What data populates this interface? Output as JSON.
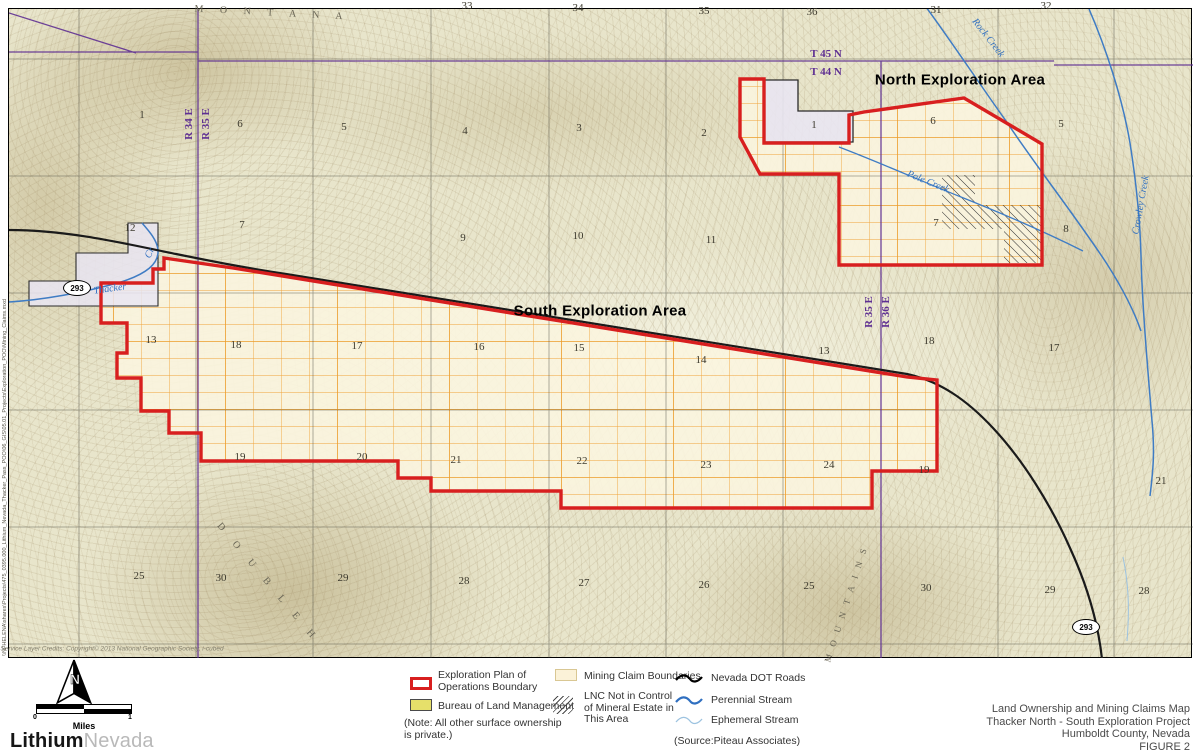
{
  "colors": {
    "boundary_red": "#d81f1f",
    "claim_orange": "#f0a238",
    "claim_fill": "#fbf6df",
    "township_purple": "#5e2f92",
    "stream_blue": "#3f7cc4",
    "ephemeral_blue": "#9dc3e0",
    "road_black": "#1a1a1a",
    "blm_yellow": "#e6e06a",
    "private_lavender": "#e9e5f2",
    "map_base": "#e8e5cb"
  },
  "map": {
    "labels": [
      {
        "t": "33",
        "x": 467,
        "y": 6,
        "cls": "sec",
        "name": "section-number"
      },
      {
        "t": "34",
        "x": 578,
        "y": 8,
        "cls": "sec",
        "name": "section-number"
      },
      {
        "t": "35",
        "x": 704,
        "y": 11,
        "cls": "sec",
        "name": "section-number"
      },
      {
        "t": "36",
        "x": 812,
        "y": 12,
        "cls": "sec",
        "name": "section-number"
      },
      {
        "t": "31",
        "x": 936,
        "y": 10,
        "cls": "sec",
        "name": "section-number"
      },
      {
        "t": "32",
        "x": 1046,
        "y": 6,
        "cls": "sec",
        "name": "section-number"
      },
      {
        "t": "1",
        "x": 142,
        "y": 115,
        "cls": "sec",
        "name": "section-number"
      },
      {
        "t": "6",
        "x": 240,
        "y": 124,
        "cls": "sec",
        "name": "section-number"
      },
      {
        "t": "5",
        "x": 344,
        "y": 127,
        "cls": "sec",
        "name": "section-number"
      },
      {
        "t": "4",
        "x": 465,
        "y": 131,
        "cls": "sec",
        "name": "section-number"
      },
      {
        "t": "3",
        "x": 579,
        "y": 128,
        "cls": "sec",
        "name": "section-number"
      },
      {
        "t": "2",
        "x": 704,
        "y": 133,
        "cls": "sec",
        "name": "section-number"
      },
      {
        "t": "1",
        "x": 814,
        "y": 125,
        "cls": "sec",
        "name": "section-number"
      },
      {
        "t": "6",
        "x": 933,
        "y": 121,
        "cls": "sec",
        "name": "section-number"
      },
      {
        "t": "5",
        "x": 1061,
        "y": 124,
        "cls": "sec",
        "name": "section-number"
      },
      {
        "t": "12",
        "x": 130,
        "y": 228,
        "cls": "sec",
        "name": "section-number"
      },
      {
        "t": "7",
        "x": 242,
        "y": 225,
        "cls": "sec",
        "name": "section-number"
      },
      {
        "t": "9",
        "x": 463,
        "y": 238,
        "cls": "sec",
        "name": "section-number"
      },
      {
        "t": "10",
        "x": 578,
        "y": 236,
        "cls": "sec",
        "name": "section-number"
      },
      {
        "t": "11",
        "x": 711,
        "y": 240,
        "cls": "sec",
        "name": "section-number"
      },
      {
        "t": "7",
        "x": 936,
        "y": 223,
        "cls": "sec",
        "name": "section-number"
      },
      {
        "t": "8",
        "x": 1066,
        "y": 229,
        "cls": "sec",
        "name": "section-number"
      },
      {
        "t": "13",
        "x": 151,
        "y": 340,
        "cls": "sec",
        "name": "section-number"
      },
      {
        "t": "18",
        "x": 236,
        "y": 345,
        "cls": "sec",
        "name": "section-number"
      },
      {
        "t": "17",
        "x": 357,
        "y": 346,
        "cls": "sec",
        "name": "section-number"
      },
      {
        "t": "16",
        "x": 479,
        "y": 347,
        "cls": "sec",
        "name": "section-number"
      },
      {
        "t": "15",
        "x": 579,
        "y": 348,
        "cls": "sec",
        "name": "section-number"
      },
      {
        "t": "14",
        "x": 701,
        "y": 360,
        "cls": "sec",
        "name": "section-number"
      },
      {
        "t": "13",
        "x": 824,
        "y": 351,
        "cls": "sec",
        "name": "section-number"
      },
      {
        "t": "18",
        "x": 929,
        "y": 341,
        "cls": "sec",
        "name": "section-number"
      },
      {
        "t": "17",
        "x": 1054,
        "y": 348,
        "cls": "sec",
        "name": "section-number"
      },
      {
        "t": "19",
        "x": 240,
        "y": 457,
        "cls": "sec",
        "name": "section-number"
      },
      {
        "t": "20",
        "x": 362,
        "y": 457,
        "cls": "sec",
        "name": "section-number"
      },
      {
        "t": "21",
        "x": 456,
        "y": 460,
        "cls": "sec",
        "name": "section-number"
      },
      {
        "t": "22",
        "x": 582,
        "y": 461,
        "cls": "sec",
        "name": "section-number"
      },
      {
        "t": "23",
        "x": 706,
        "y": 465,
        "cls": "sec",
        "name": "section-number"
      },
      {
        "t": "24",
        "x": 829,
        "y": 465,
        "cls": "sec",
        "name": "section-number"
      },
      {
        "t": "19",
        "x": 924,
        "y": 470,
        "cls": "sec",
        "name": "section-number"
      },
      {
        "t": "21",
        "x": 1161,
        "y": 481,
        "cls": "sec",
        "name": "section-number"
      },
      {
        "t": "25",
        "x": 139,
        "y": 576,
        "cls": "sec",
        "name": "section-number"
      },
      {
        "t": "30",
        "x": 221,
        "y": 578,
        "cls": "sec",
        "name": "section-number"
      },
      {
        "t": "29",
        "x": 343,
        "y": 578,
        "cls": "sec",
        "name": "section-number"
      },
      {
        "t": "28",
        "x": 464,
        "y": 581,
        "cls": "sec",
        "name": "section-number"
      },
      {
        "t": "27",
        "x": 584,
        "y": 583,
        "cls": "sec",
        "name": "section-number"
      },
      {
        "t": "26",
        "x": 704,
        "y": 585,
        "cls": "sec",
        "name": "section-number"
      },
      {
        "t": "25",
        "x": 809,
        "y": 586,
        "cls": "sec",
        "name": "section-number"
      },
      {
        "t": "30",
        "x": 926,
        "y": 588,
        "cls": "sec",
        "name": "section-number"
      },
      {
        "t": "29",
        "x": 1050,
        "y": 590,
        "cls": "sec",
        "name": "section-number"
      },
      {
        "t": "28",
        "x": 1144,
        "y": 591,
        "cls": "sec",
        "name": "section-number"
      },
      {
        "t": "T 45 N",
        "x": 826,
        "y": 54,
        "cls": "town",
        "name": "township-label"
      },
      {
        "t": "T 44 N",
        "x": 826,
        "y": 72,
        "cls": "town",
        "name": "township-label"
      },
      {
        "t": "R 34 E",
        "x": 189,
        "y": 124,
        "cls": "range",
        "rot": -90,
        "name": "range-label"
      },
      {
        "t": "R 35 E",
        "x": 206,
        "y": 124,
        "cls": "range",
        "rot": -90,
        "name": "range-label"
      },
      {
        "t": "R 35 E",
        "x": 869,
        "y": 312,
        "cls": "range",
        "rot": -90,
        "name": "range-label"
      },
      {
        "t": "R 36 E",
        "x": 886,
        "y": 312,
        "cls": "range",
        "rot": -90,
        "name": "range-label"
      },
      {
        "t": "North Exploration Area",
        "x": 960,
        "y": 80,
        "cls": "area",
        "name": "north-area-label"
      },
      {
        "t": "South Exploration Area",
        "x": 600,
        "y": 311,
        "cls": "area",
        "name": "south-area-label"
      },
      {
        "t": "Rock Creek",
        "x": 988,
        "y": 38,
        "cls": "creek",
        "rot": 52,
        "name": "creek-label"
      },
      {
        "t": "Crowley Creek",
        "x": 1141,
        "y": 205,
        "cls": "creek",
        "rot": -80,
        "name": "creek-label"
      },
      {
        "t": "Pole Creek",
        "x": 928,
        "y": 182,
        "cls": "creek",
        "rot": 22,
        "name": "creek-label"
      },
      {
        "t": "Thacker",
        "x": 110,
        "y": 289,
        "cls": "creek",
        "rot": -8,
        "name": "creek-label"
      },
      {
        "t": "Cr",
        "x": 150,
        "y": 253,
        "cls": "creek",
        "rot": -65,
        "name": "creek-label"
      },
      {
        "t": "M O N T A N A",
        "x": 272,
        "y": 13,
        "cls": "mtn",
        "rot": 3,
        "name": "mountain-label"
      },
      {
        "t": "D O U B L E   H",
        "x": 268,
        "y": 583,
        "cls": "mtn",
        "rot": 50,
        "name": "mountain-label"
      },
      {
        "t": "M O U N T A I N S",
        "x": 846,
        "y": 604,
        "cls": "mtn mtn2",
        "rot": -72,
        "name": "mountain-label"
      },
      {
        "t": "Service Layer Credits: Copyright© 2013 National Geographic Society, i-cubed",
        "x": 112,
        "y": 649,
        "cls": "credits",
        "name": "credits-text"
      }
    ],
    "shields": [
      {
        "label": "293",
        "x": 77,
        "y": 288
      },
      {
        "label": "293",
        "x": 1086,
        "y": 627
      }
    ],
    "file_path": "\\\\NFHELENA\\shares\\Projects\\475_0395.000_Lithium_Nevada_Thacker_Pass_POO\\06_GIS\\05.01_Projects\\Exploration_POO\\Mining_Claims.mxd"
  },
  "legend": {
    "exploration_line1": "Exploration Plan of",
    "exploration_line2": "Operations Boundary",
    "blm": "Bureau of Land Management",
    "note_line1": "(Note: All other surface ownership",
    "note_line2": "is private.)",
    "claims": "Mining Claim Boundaries",
    "lnc_line1": "LNC Not in Control",
    "lnc_line2": "of Mineral Estate in",
    "lnc_line3": "This Area",
    "roads": "Nevada DOT Roads",
    "perennial": "Perennial Stream",
    "ephemeral": "Ephemeral Stream",
    "source": "(Source:Piteau Associates)"
  },
  "footer": {
    "north_arrow_letter": "N",
    "scale_left": "0",
    "scale_right": "1",
    "scale_units": "Miles",
    "logo_bold": "Lithium",
    "logo_light": "Nevada",
    "title_line1": "Land Ownership and Mining Claims Map",
    "title_line2": "Thacker North - South Exploration Project",
    "title_line3": "Humboldt County, Nevada",
    "title_line4": "FIGURE 2"
  }
}
